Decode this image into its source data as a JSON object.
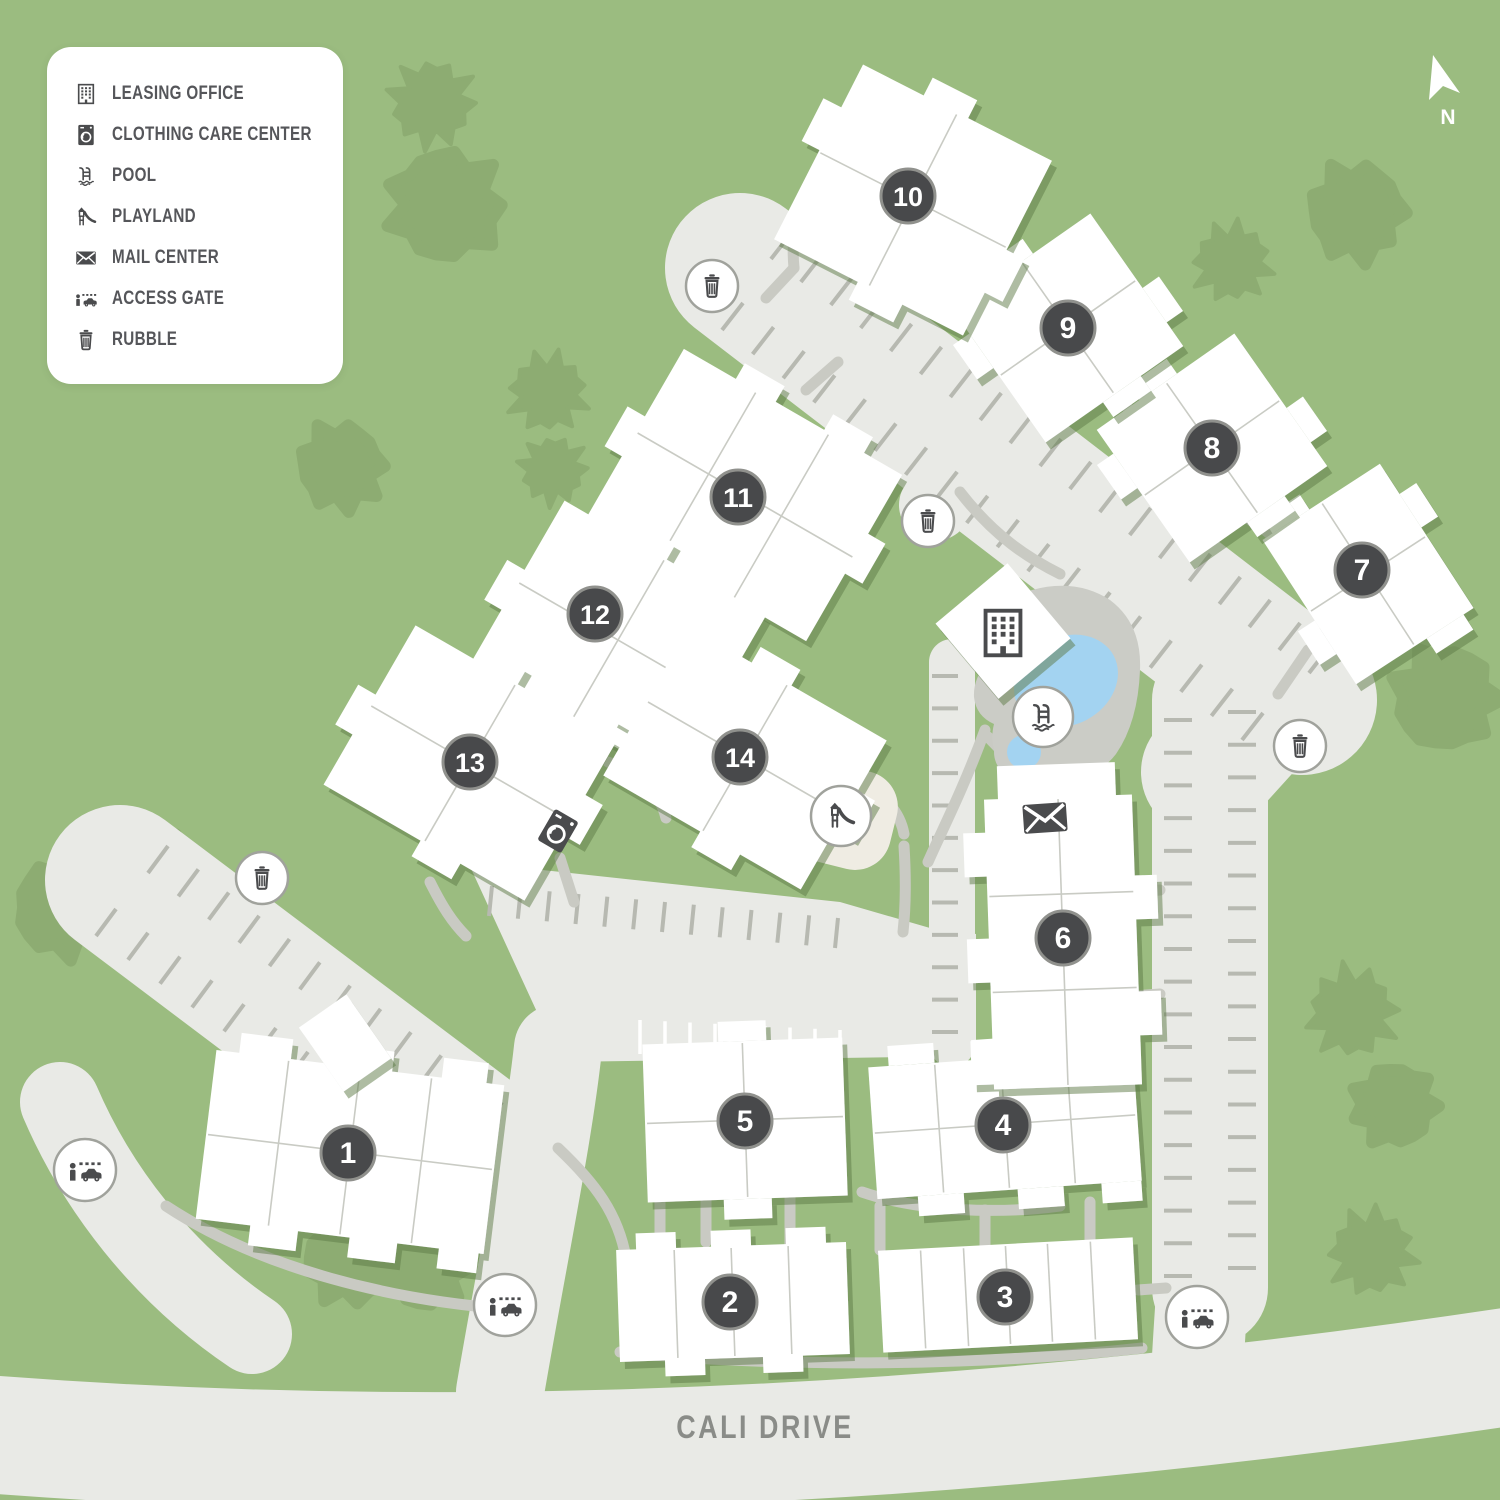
{
  "legend": {
    "items": [
      {
        "icon": "leasing-office-icon",
        "label": "LEASING OFFICE"
      },
      {
        "icon": "clothing-care-icon",
        "label": "CLOTHING CARE CENTER"
      },
      {
        "icon": "pool-icon",
        "label": "POOL"
      },
      {
        "icon": "playland-icon",
        "label": "PLAYLAND"
      },
      {
        "icon": "mail-center-icon",
        "label": "MAIL CENTER"
      },
      {
        "icon": "access-gate-icon",
        "label": "ACCESS GATE"
      },
      {
        "icon": "rubble-icon",
        "label": "RUBBLE"
      }
    ]
  },
  "street": {
    "label": "CALI DRIVE"
  },
  "compass": {
    "label": "N"
  },
  "buildings": [
    {
      "number": "1",
      "x": 348,
      "y": 1153
    },
    {
      "number": "2",
      "x": 730,
      "y": 1302
    },
    {
      "number": "3",
      "x": 1005,
      "y": 1297
    },
    {
      "number": "4",
      "x": 1003,
      "y": 1125
    },
    {
      "number": "5",
      "x": 745,
      "y": 1121
    },
    {
      "number": "6",
      "x": 1063,
      "y": 938
    },
    {
      "number": "7",
      "x": 1362,
      "y": 570
    },
    {
      "number": "8",
      "x": 1212,
      "y": 448
    },
    {
      "number": "9",
      "x": 1068,
      "y": 328
    },
    {
      "number": "10",
      "x": 908,
      "y": 196
    },
    {
      "number": "11",
      "x": 738,
      "y": 497
    },
    {
      "number": "12",
      "x": 595,
      "y": 614
    },
    {
      "number": "13",
      "x": 470,
      "y": 762
    },
    {
      "number": "14",
      "x": 740,
      "y": 757
    }
  ],
  "amenities": [
    {
      "type": "leasing-office",
      "x": 1003,
      "y": 633
    },
    {
      "type": "clothing-care",
      "x": 558,
      "y": 831
    },
    {
      "type": "pool",
      "x": 1043,
      "y": 717
    },
    {
      "type": "playland",
      "x": 841,
      "y": 816
    },
    {
      "type": "mail-center",
      "x": 1045,
      "y": 818
    },
    {
      "type": "access-gate",
      "x": 85,
      "y": 1170
    },
    {
      "type": "access-gate",
      "x": 505,
      "y": 1305
    },
    {
      "type": "access-gate",
      "x": 1197,
      "y": 1317
    },
    {
      "type": "rubble",
      "x": 712,
      "y": 286
    },
    {
      "type": "rubble",
      "x": 928,
      "y": 521
    },
    {
      "type": "rubble",
      "x": 1300,
      "y": 746
    },
    {
      "type": "rubble",
      "x": 262,
      "y": 878
    }
  ],
  "colors": {
    "background": "#9bbc80",
    "tree": "#8dac72",
    "road": "#e9eae6",
    "parking_tick": "#b7b9b1",
    "path": "#c9cac3",
    "building": "#ffffff",
    "badge": "#48494b",
    "badge_ring": "#90918d",
    "icon": "#4a4b4d",
    "pool_water": "#a3d3f1",
    "pool_deck": "#cbccc6",
    "playland_pad": "#efece3",
    "legend_text": "#55565a",
    "street_text": "#8a8c88"
  }
}
